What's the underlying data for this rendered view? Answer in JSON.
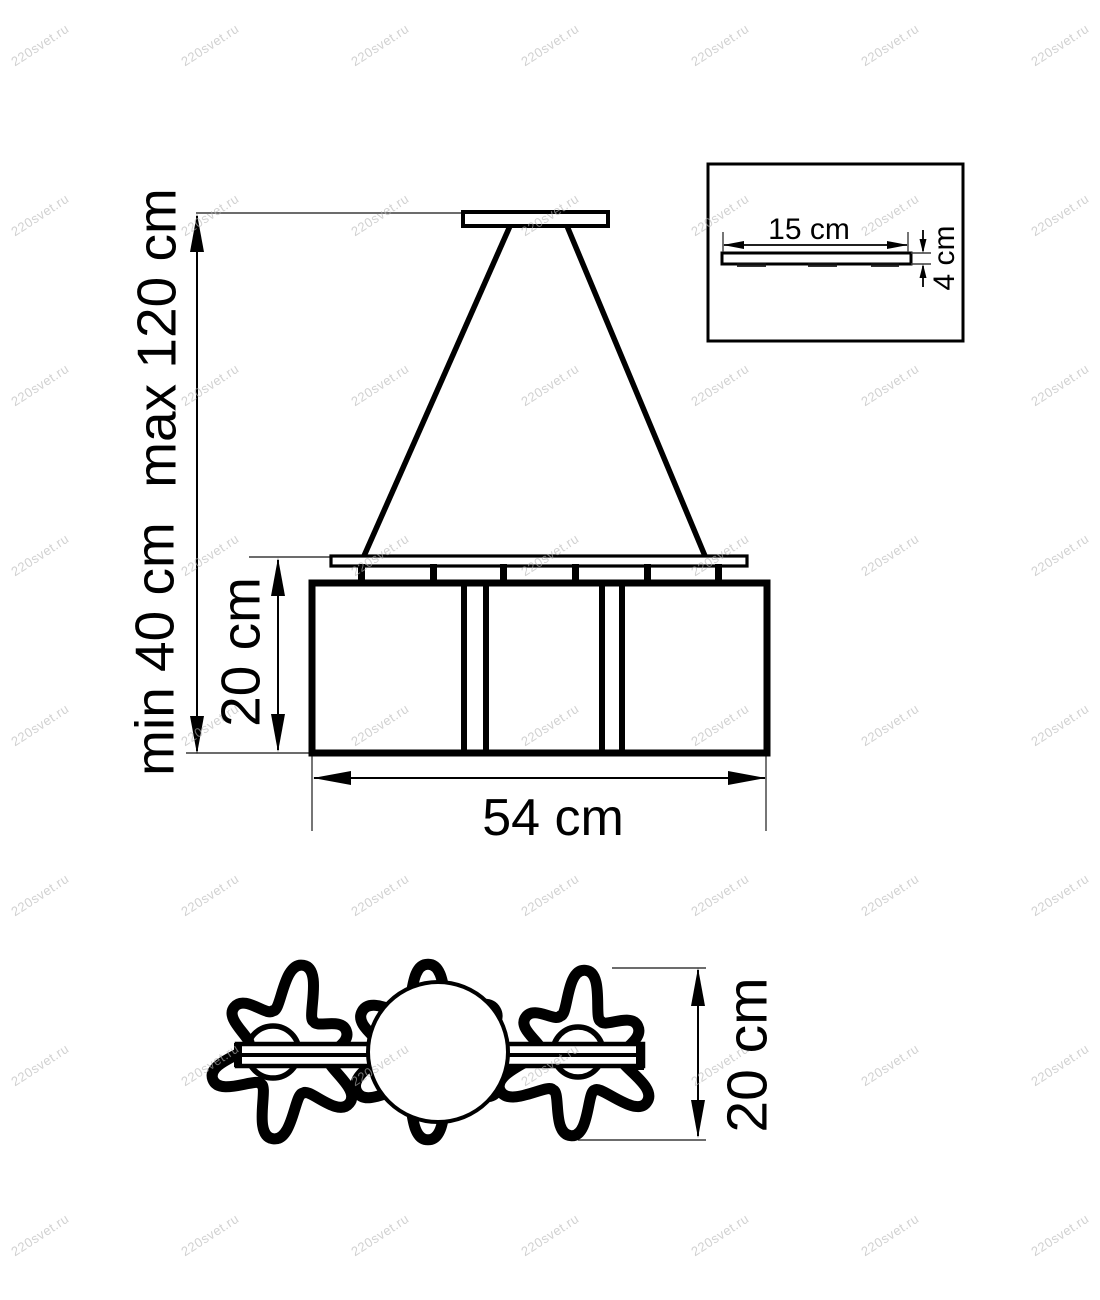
{
  "watermark": {
    "text": "220svet.ru"
  },
  "colors": {
    "line": "#000000",
    "watermark": "#b5b5b5"
  },
  "side_view": {
    "labels": {
      "max_height": "max 120 cm",
      "min_height": "min 40 cm",
      "shade_height": "20 cm",
      "width": "54 cm"
    }
  },
  "canopy_detail": {
    "labels": {
      "width": "15 cm",
      "height": "4 cm"
    }
  },
  "top_view": {
    "labels": {
      "depth": "20 cm"
    }
  }
}
